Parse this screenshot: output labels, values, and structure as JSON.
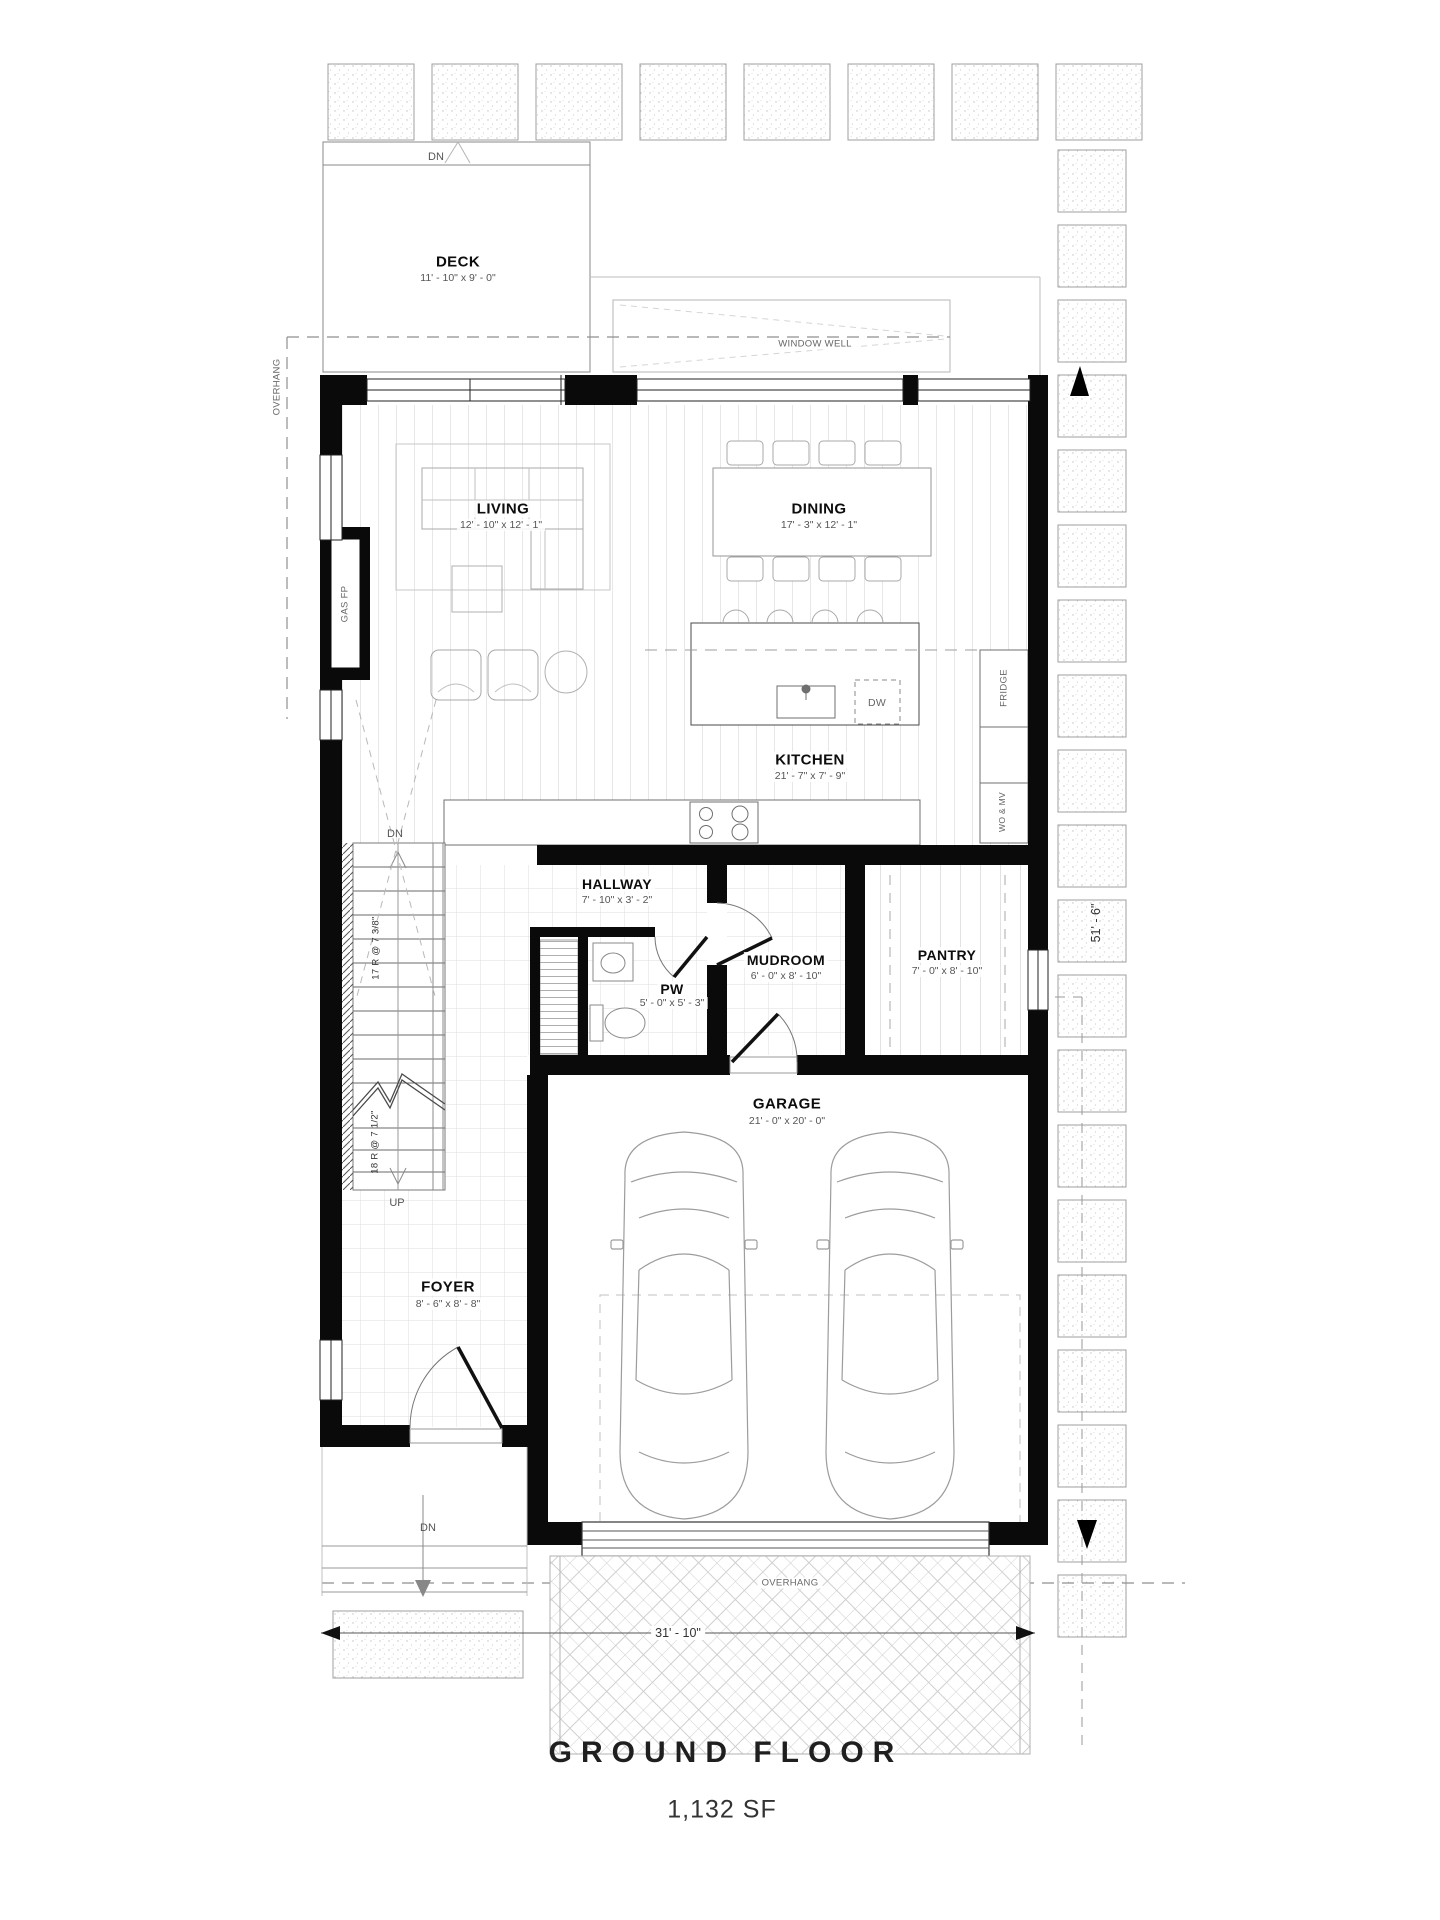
{
  "plan": {
    "title": "GROUND FLOOR",
    "area": "1,132 SF",
    "rooms": {
      "deck": {
        "name": "DECK",
        "dims": "11' - 10\" x 9' - 0\""
      },
      "living": {
        "name": "LIVING",
        "dims": "12' - 10\" x 12' - 1\""
      },
      "dining": {
        "name": "DINING",
        "dims": "17' - 3\" x 12' - 1\""
      },
      "kitchen": {
        "name": "KITCHEN",
        "dims": "21' - 7\" x 7' - 9\""
      },
      "hallway": {
        "name": "HALLWAY",
        "dims": "7' - 10\" x 3' - 2\""
      },
      "pw": {
        "name": "PW",
        "dims": "5' - 0\" x 5' - 3\""
      },
      "mudroom": {
        "name": "MUDROOM",
        "dims": "6' - 0\" x 8' - 10\""
      },
      "pantry": {
        "name": "PANTRY",
        "dims": "7' - 0\" x 8' - 10\""
      },
      "garage": {
        "name": "GARAGE",
        "dims": "21' - 0\" x 20' - 0\""
      },
      "foyer": {
        "name": "FOYER",
        "dims": "8' - 6\" x 8' - 8\""
      }
    },
    "stairs": {
      "upper_riser_note": "17 R @ 7 3/8\"",
      "lower_riser_note": "18 R @ 7 1/2\"",
      "down_label": "DN",
      "up_label": "UP"
    },
    "annotations": {
      "window_well": "WINDOW WELL",
      "overhang_left": "OVERHANG",
      "overhang_bottom": "OVERHANG",
      "gas_fireplace": "GAS FP",
      "fridge": "FRIDGE",
      "wall_oven_microwave": "WO & MV",
      "dishwasher": "DW",
      "deck_down": "DN",
      "porch_down": "DN"
    },
    "dimensions": {
      "overall_width": "31' - 10\"",
      "overall_depth": "51' - 6\""
    },
    "colors": {
      "wall": "#0a0a0a",
      "line_light": "#bbbbbb",
      "text_dark": "#111111",
      "text_dim": "#555555"
    }
  }
}
